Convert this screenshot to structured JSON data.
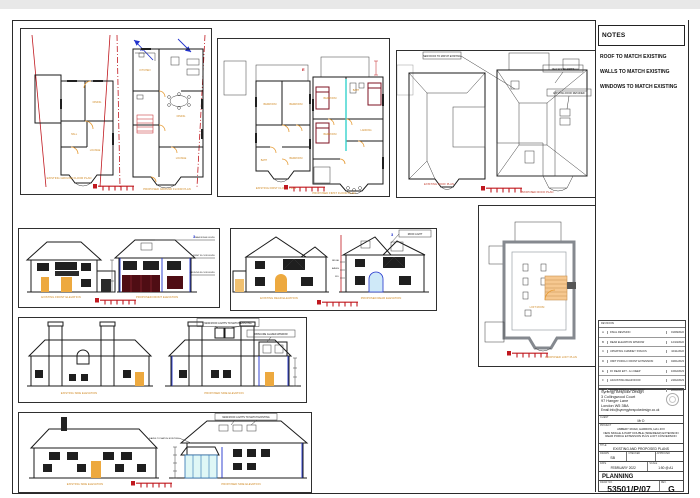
{
  "notes": {
    "header": "NOTES",
    "line1": "ROOF TO MATCH EXISTING",
    "line2": "WALLS TO MATCH EXISTING",
    "line3": "WINDOWS TO MATCH EXISTING"
  },
  "revisions": {
    "header": "REVISIONS",
    "rows": [
      {
        "rev": "A",
        "desc": "FINAL REVISION",
        "date": "01/08/2022"
      },
      {
        "rev": "B",
        "desc": "REAR ELEVATION WINDOW",
        "date": "12/10/2022"
      },
      {
        "rev": "C",
        "desc": "UPDATING CHIMNEY STACKS",
        "date": "10/11/2022"
      },
      {
        "rev": "D",
        "desc": "OMIT PORCH / FRONT EXTENSION",
        "date": "04/01/2023"
      },
      {
        "rev": "E",
        "desc": "FF REAR EXT - 1m DEEP",
        "date": "16/02/2023"
      },
      {
        "rev": "F",
        "desc": "ADJUSTING REAR ROOF",
        "date": "24/02/2023"
      },
      {
        "rev": "G",
        "desc": "DOWN PIPES & SOAK AWAY",
        "date": "28/02/2023"
      }
    ]
  },
  "company": {
    "name": "Synergy Bespoke Design",
    "address1": "3 Collingwood Court",
    "address2": "97 Hanger Lane",
    "address3": "London W5 3BA",
    "email": "Email:info@synergybespokedesign.co.uk"
  },
  "titleblock": {
    "client_label": "CLIENT",
    "client": "Mr D",
    "project_label": "PROJECT",
    "project1": "AMBERY ROAD, HARROW, HA1 4XX",
    "project2": "NEW SINGLE & PART DOUBLE (SIDE/REAR) EXTENSION",
    "project3": "REAR PORCH EXTENSION PLUS LOFT CONVERSION",
    "title_label": "TITLE",
    "title": "EXISTING AND PROPOSED PLANS",
    "drawn_label": "DRAWN",
    "drawn": "SB",
    "checked_label": "CHECKED",
    "checked": "",
    "approved_label": "APPROVED",
    "approved": "",
    "date_label": "DATE",
    "date": "FEBRUARY 2022",
    "scale_label": "SCALE",
    "scale": "1:50 @ A1",
    "status": "PLANNING",
    "drawno_label": "DRAW. NO.",
    "drawno": "53501/P/07",
    "rev_label": "REV.",
    "rev": "G"
  },
  "captions": {
    "p1a": "EXISTING GROUND FLOOR PLAN",
    "p1b": "PROPOSED GROUND FLOOR PLAN",
    "p2a": "EXISTING FIRST FLOOR PLAN",
    "p2b": "PROPOSED FIRST FLOOR PLAN",
    "p3a": "EXISTING ROOF PLAN",
    "p3b": "PROPOSED ROOF PLAN",
    "p4a": "EXISTING FRONT ELEVATION",
    "p4b": "PROPOSED FRONT ELEVATION",
    "p5a": "EXISTING REAR ELEVATION",
    "p5b": "PROPOSED REAR ELEVATION",
    "p6": "PROPOSED LOFT PLAN",
    "p7a": "EXISTING SIDE ELEVATION",
    "p7b": "PROPOSED SIDE ELEVATION",
    "p8a": "EXISTING SIDE ELEVATION",
    "p8b": "PROPOSED SIDE ELEVATION"
  },
  "rooms": {
    "lounge": "LOUNGE",
    "dining": "DINING",
    "kitchen": "KITCHEN",
    "hall": "HALL",
    "bedroom": "BEDROOM",
    "bath": "BATH",
    "landing": "LANDING",
    "loft": "LOFT ROOM"
  },
  "ann": {
    "north": "N",
    "section": "E",
    "three": "3",
    "roofplan1": "NEW ROOF TO MATCH EXISTING",
    "roofplan2": "NEW ROOF LIGHTS",
    "roofplan3": "EXISTING ROOF RETAINED",
    "front_dim1": "MAX RIDGE LEVEL",
    "front_dim2": "FIRST FLOOR LEVEL",
    "front_dim3": "GROUND FLOOR LEVEL",
    "rear_note": "ROOF LIGHT",
    "rear_dim1": "RIDGE",
    "rear_dim2": "EAVES",
    "rear_dim3": "FFL",
    "side1_note1": "NEW ROOF LIGHTS TO MATCH EXISTING",
    "side1_note2": "OBSCURE GLAZED WINDOW",
    "side2_note1": "NEW ROOF LIGHTS TO MATCH EXISTING",
    "side2_note2": "EAVES TO MATCH EXISTING"
  },
  "colors": {
    "roof_existing_cyan": "#8ceeea",
    "roof_proposed_pink": "#e7cbf0",
    "roof_gray": "#c9ccd0",
    "door_orange": "#eda93f",
    "marking_red": "#c0181f",
    "pipe_blue": "#2233cc",
    "garage_darkred": "#4f0d14"
  }
}
